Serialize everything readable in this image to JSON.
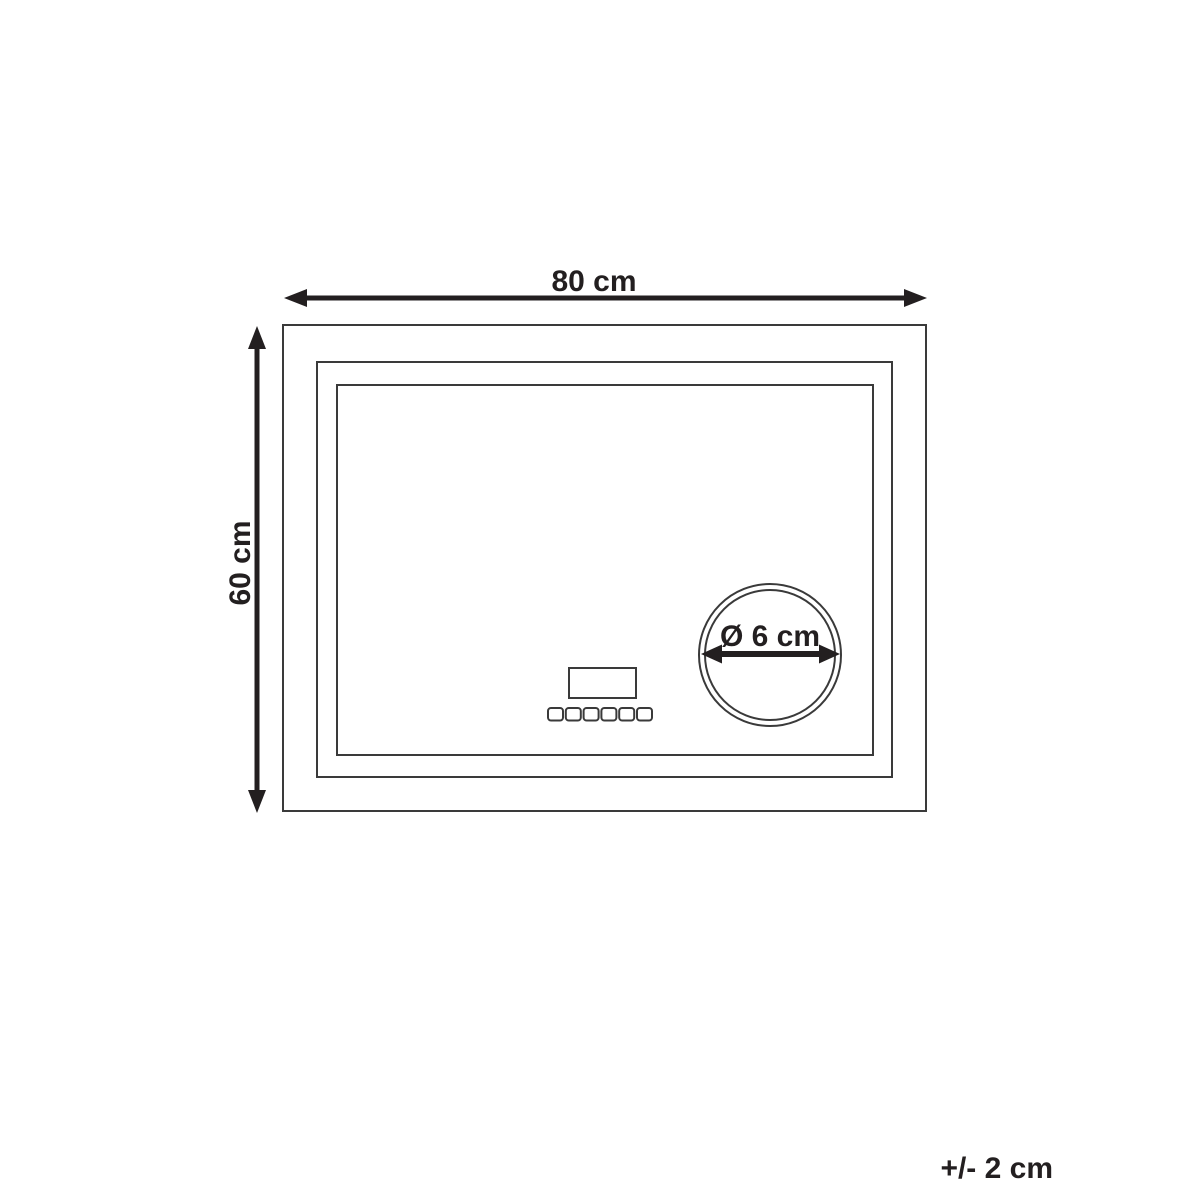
{
  "diagram": {
    "width_label": "80 cm",
    "height_label": "60 cm",
    "diameter_label": "Ø 6 cm",
    "tolerance_label": "+/- 2 cm",
    "colors": {
      "ink": "#231f20",
      "line": "#3a3a3a",
      "background": "#ffffff"
    }
  }
}
